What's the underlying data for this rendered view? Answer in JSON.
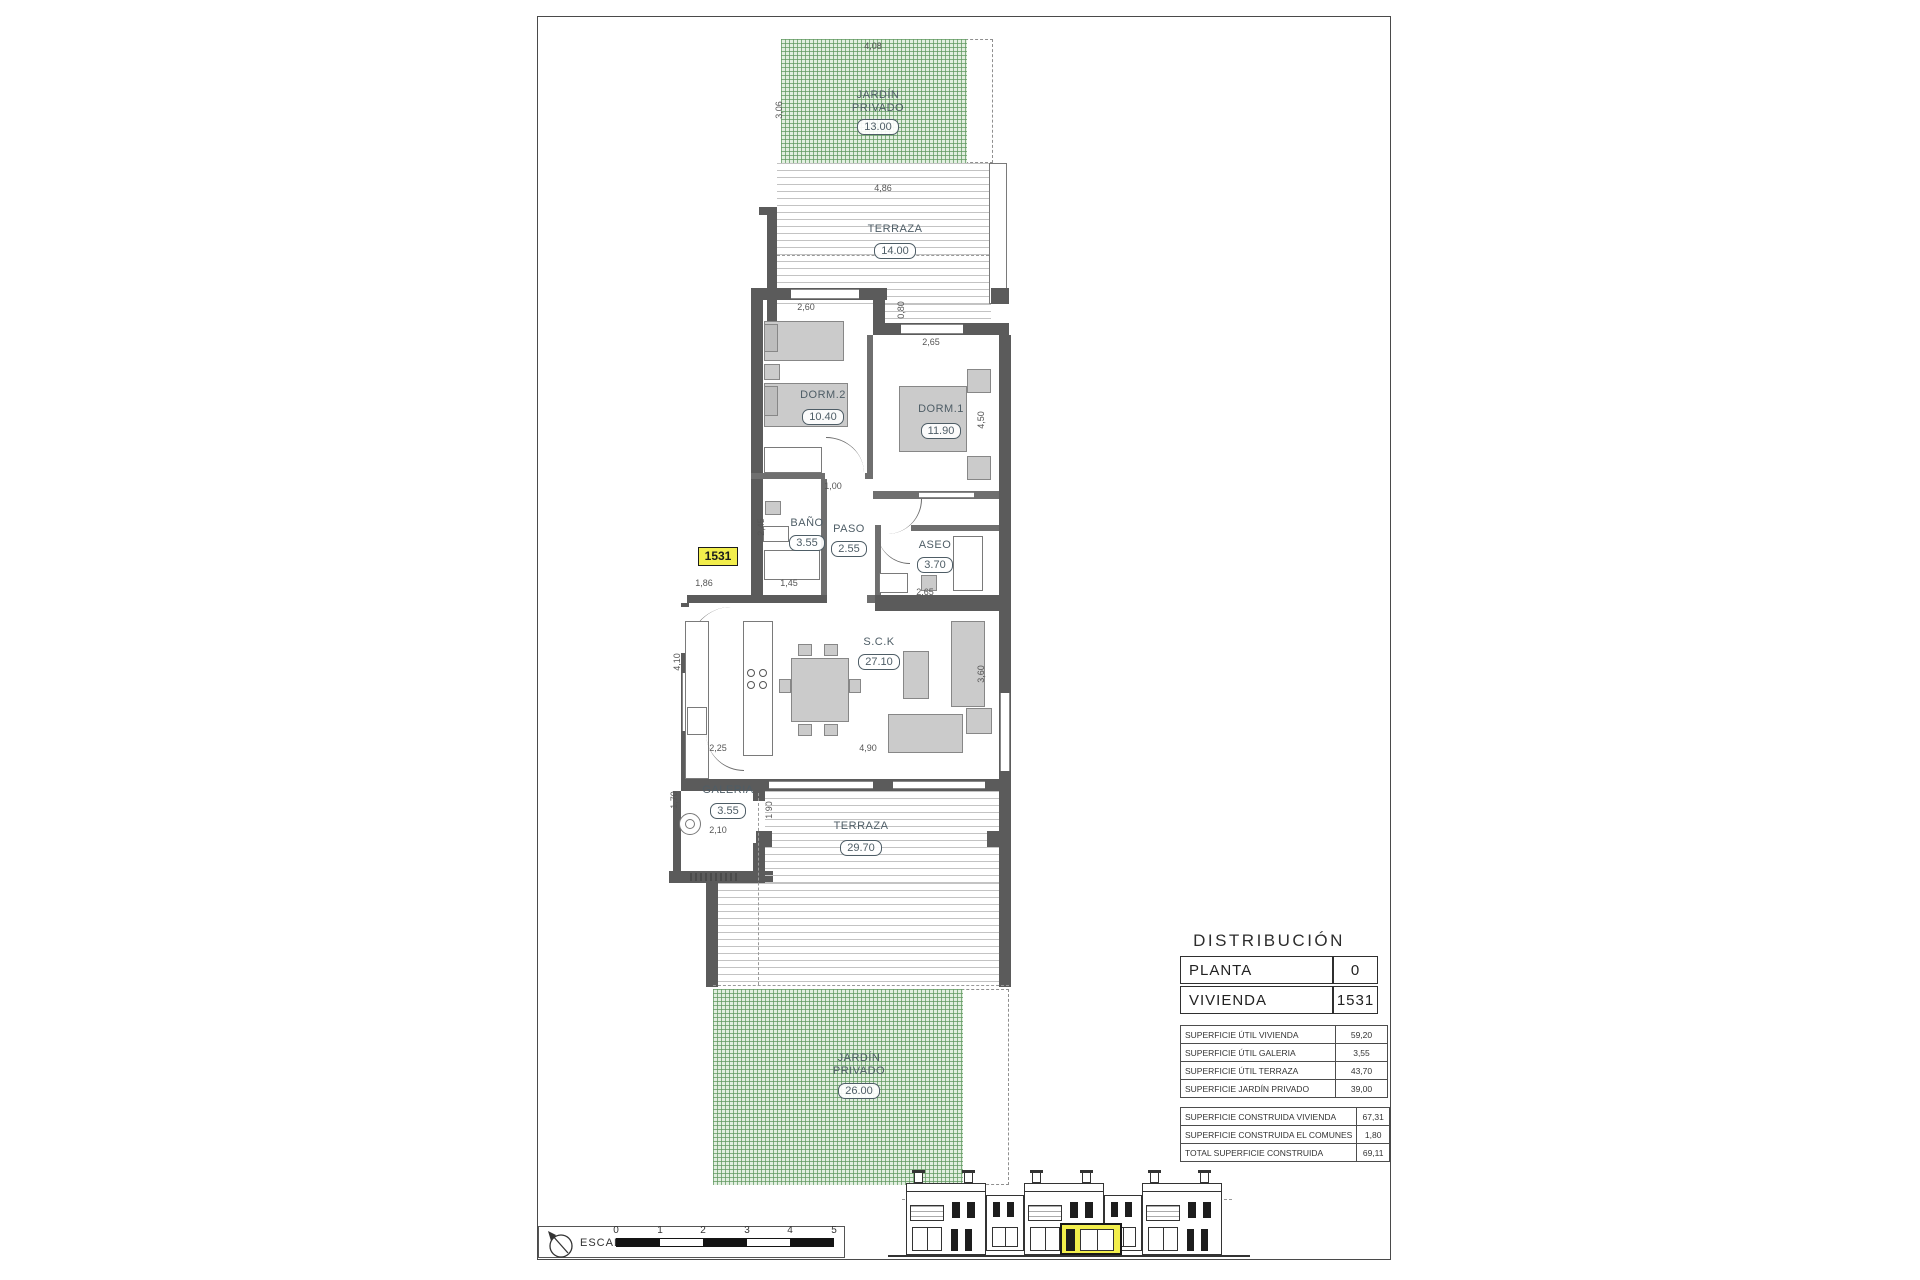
{
  "sheet": {
    "unit_tag": "1531",
    "rooms": {
      "jardin_top": {
        "name": "JARDÍN PRIVADO",
        "area": "13.00"
      },
      "terraza_top": {
        "name": "TERRAZA",
        "area": "14.00"
      },
      "dorm2": {
        "name": "DORM.2",
        "area": "10.40"
      },
      "dorm1": {
        "name": "DORM.1",
        "area": "11.90"
      },
      "bano": {
        "name": "BAÑO",
        "area": "3.55"
      },
      "paso": {
        "name": "PASO",
        "area": "2.55"
      },
      "aseo": {
        "name": "ASEO",
        "area": "3.70"
      },
      "sck": {
        "name": "S.C.K",
        "area": "27.10"
      },
      "galeria": {
        "name": "GALERIA",
        "area": "3.55"
      },
      "terraza_main": {
        "name": "TERRAZA",
        "area": "29.70"
      },
      "jardin_bottom": {
        "name": "JARDÍN PRIVADO",
        "area": "26.00"
      }
    },
    "dims": {
      "garden_top_width": "4,08",
      "garden_top_depth": "3,06",
      "terrace_top_width": "4,86",
      "dorm2_width": "2,60",
      "terrace_edge": "0,80",
      "dorm1_width": "2,65",
      "dorm1_depth": "4,50",
      "hall_opening": "1,00",
      "bano_depth": "2,45",
      "bano_width": "1,45",
      "entry_width": "1,86",
      "aseo_width": "2,65",
      "kitchen_depth": "4,10",
      "kitchen_width": "2,25",
      "living_width": "4,90",
      "living_depth": "3,60",
      "galeria_depth": "1,70",
      "galeria_width": "2,10",
      "galeria_opening": "1,90"
    },
    "distribution": {
      "title": "DISTRIBUCIÓN",
      "header_rows": [
        {
          "label": "PLANTA",
          "value": "0"
        },
        {
          "label": "VIVIENDA",
          "value": "1531"
        }
      ],
      "util_rows": [
        {
          "label": "SUPERFICIE ÚTIL VIVIENDA",
          "value": "59,20"
        },
        {
          "label": "SUPERFICIE ÚTIL GALERIA",
          "value": "3,55"
        },
        {
          "label": "SUPERFICIE ÚTIL TERRAZA",
          "value": "43,70"
        },
        {
          "label": "SUPERFICIE JARDÍN PRIVADO",
          "value": "39,00"
        }
      ],
      "built_rows": [
        {
          "label": "SUPERFICIE CONSTRUIDA VIVIENDA",
          "value": "67,31"
        },
        {
          "label": "SUPERFICIE CONSTRUIDA EL COMUNES",
          "value": "1,80"
        },
        {
          "label": "TOTAL SUPERFICIE CONSTRUIDA",
          "value": "69,11"
        }
      ]
    },
    "scale_bar": {
      "label": "ESCALA :",
      "ticks": [
        "0",
        "1",
        "2",
        "3",
        "4",
        "5"
      ]
    },
    "colors": {
      "garden_green": "#e2efe0",
      "wall_gray": "#5b5b5b",
      "highlight_yellow": "#f2ee4c"
    }
  }
}
